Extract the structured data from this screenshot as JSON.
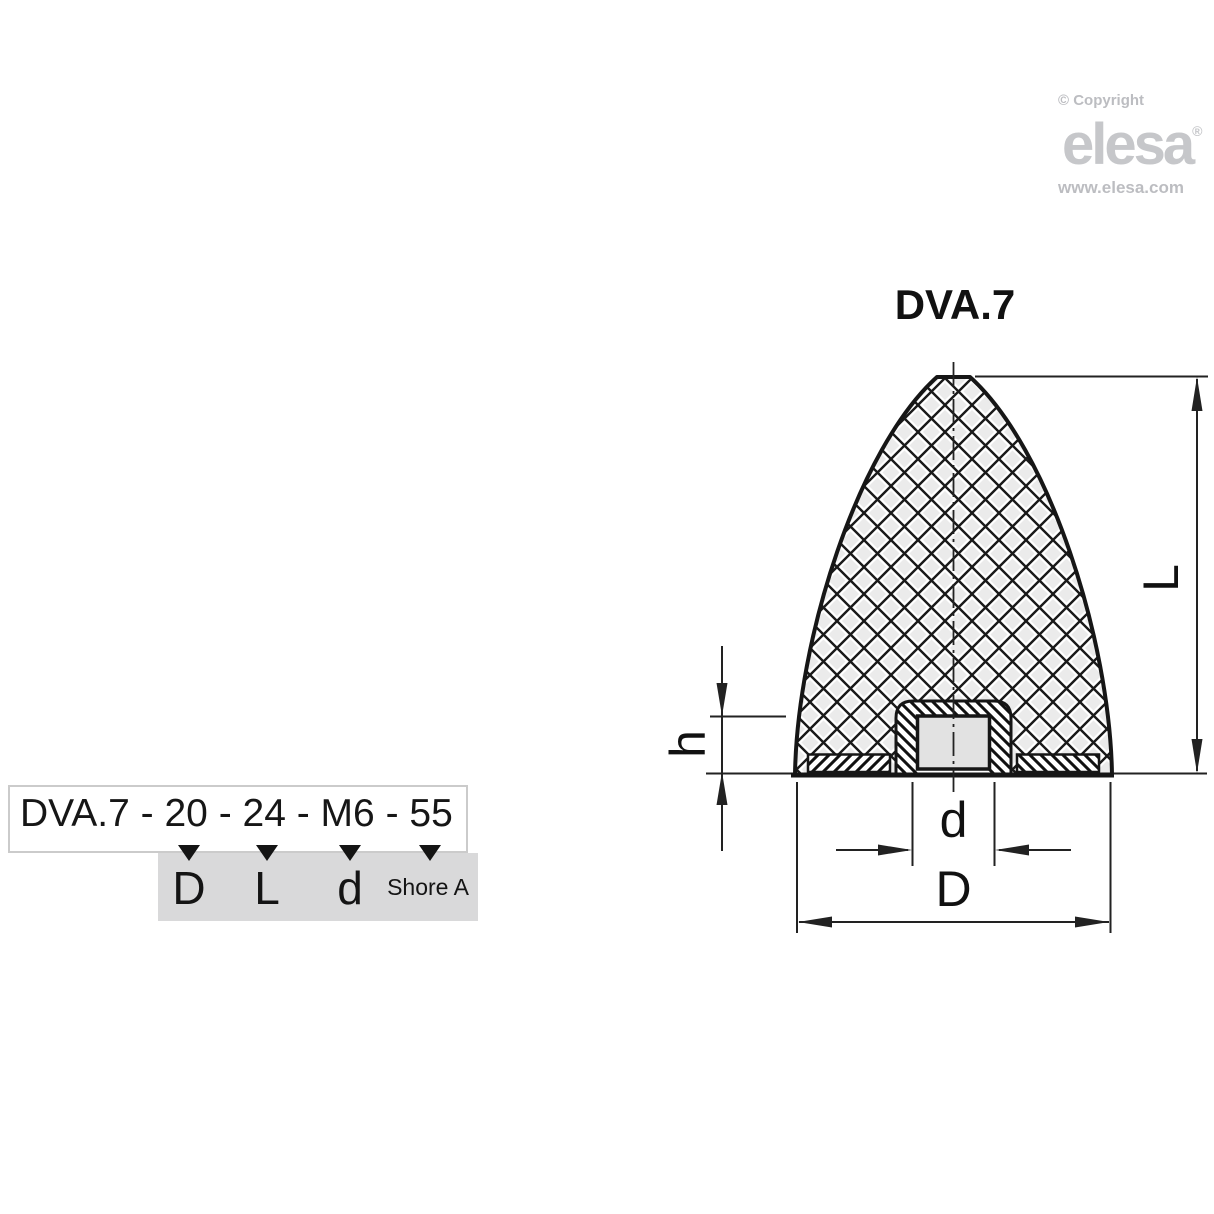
{
  "branding": {
    "copyright": "© Copyright",
    "logo_text": "elesa",
    "registered_mark": "®",
    "website": "www.elesa.com",
    "logo_color": "#c6c7ca",
    "muted_text_color": "#bcbdc1"
  },
  "drawing": {
    "title": "DVA.7",
    "dim_labels": {
      "length": "L",
      "insert_height": "h",
      "thread": "d",
      "base_diameter": "D"
    }
  },
  "order_code": {
    "code": "DVA.7 - 20 - 24 - M6 - 55",
    "arrow_icon": "triangle-down",
    "legend_fill": "#d9d9da",
    "mapping": [
      {
        "label": "D"
      },
      {
        "label": "L"
      },
      {
        "label": "d"
      },
      {
        "label": "Shore A"
      }
    ]
  }
}
